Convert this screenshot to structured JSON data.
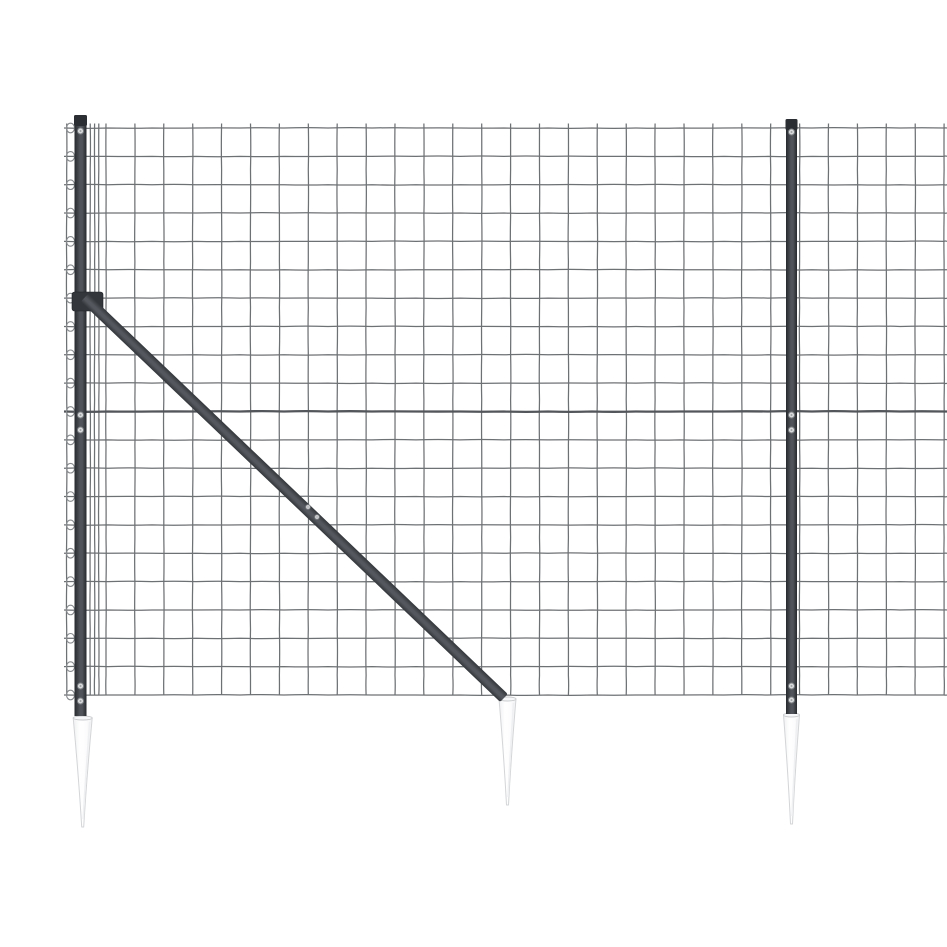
{
  "scene": {
    "description": "Product photo of an anthracite-coloured welded wire mesh fence panel with two dark metal posts, a diagonal bracing strut and three white pointed ground anchor spikes, on a plain white background",
    "background_color": "#ffffff",
    "canvas": {
      "width": 947,
      "height": 947
    }
  },
  "fence": {
    "mesh": {
      "left": 64,
      "right": 947,
      "top_wire_y": 128,
      "row_step": 28.35,
      "row_count": 21,
      "thick_row_index": 10,
      "col_start": 106,
      "col_step": 28.9,
      "col_count": 30,
      "col_top": 123.5,
      "col_bottom": 695,
      "edge_cols": [
        66.7,
        90.2,
        94.6,
        98.8
      ],
      "loop_x": 70.5,
      "loop_rx": 4.0,
      "loop_ry": 4.8,
      "wire_color": "#6e7174",
      "wire_width": 1.25,
      "thick_wire_color": "#53565a",
      "thick_wire_width": 2.3,
      "loop_color": "#888b8e"
    },
    "posts": [
      {
        "id": "left",
        "cx": 80.5,
        "width": 12,
        "top": 115,
        "bottom": 716,
        "cap_height": 11,
        "screws": [
          131,
          415,
          430,
          686,
          701
        ]
      },
      {
        "id": "right",
        "cx": 791.5,
        "width": 11,
        "top": 119,
        "bottom": 714,
        "cap_height": 11,
        "screws": [
          132,
          415,
          430,
          686,
          700
        ]
      }
    ],
    "brace": {
      "x1": 86,
      "y1": 299,
      "x2": 504,
      "y2": 698,
      "width": 11,
      "clamp": {
        "x": 72,
        "y": 292,
        "w": 31,
        "h": 19
      },
      "screws": [
        [
          308,
          507
        ],
        [
          317,
          517
        ]
      ]
    },
    "spikes": [
      {
        "id": "left",
        "cx": 82.7,
        "top": 716,
        "bottom": 827,
        "top_width": 19
      },
      {
        "id": "middle",
        "cx": 507.5,
        "top": 697,
        "bottom": 805,
        "top_width": 17
      },
      {
        "id": "right",
        "cx": 791.5,
        "top": 713,
        "bottom": 824,
        "top_width": 16
      }
    ],
    "colors": {
      "post_dark": "#26292d",
      "post_mid": "#50545a",
      "post_cap": "#2b2e32",
      "brace_dark": "#33373b",
      "brace_mid": "#54585e",
      "spike_fill": "#fcfcfd",
      "spike_fill_shade": "#eff0f2",
      "spike_stroke": "#d3d5d7",
      "spike_rim": "#c9cbcd",
      "screw_fill": "#d7d9db",
      "screw_stroke": "#7e8184"
    }
  }
}
